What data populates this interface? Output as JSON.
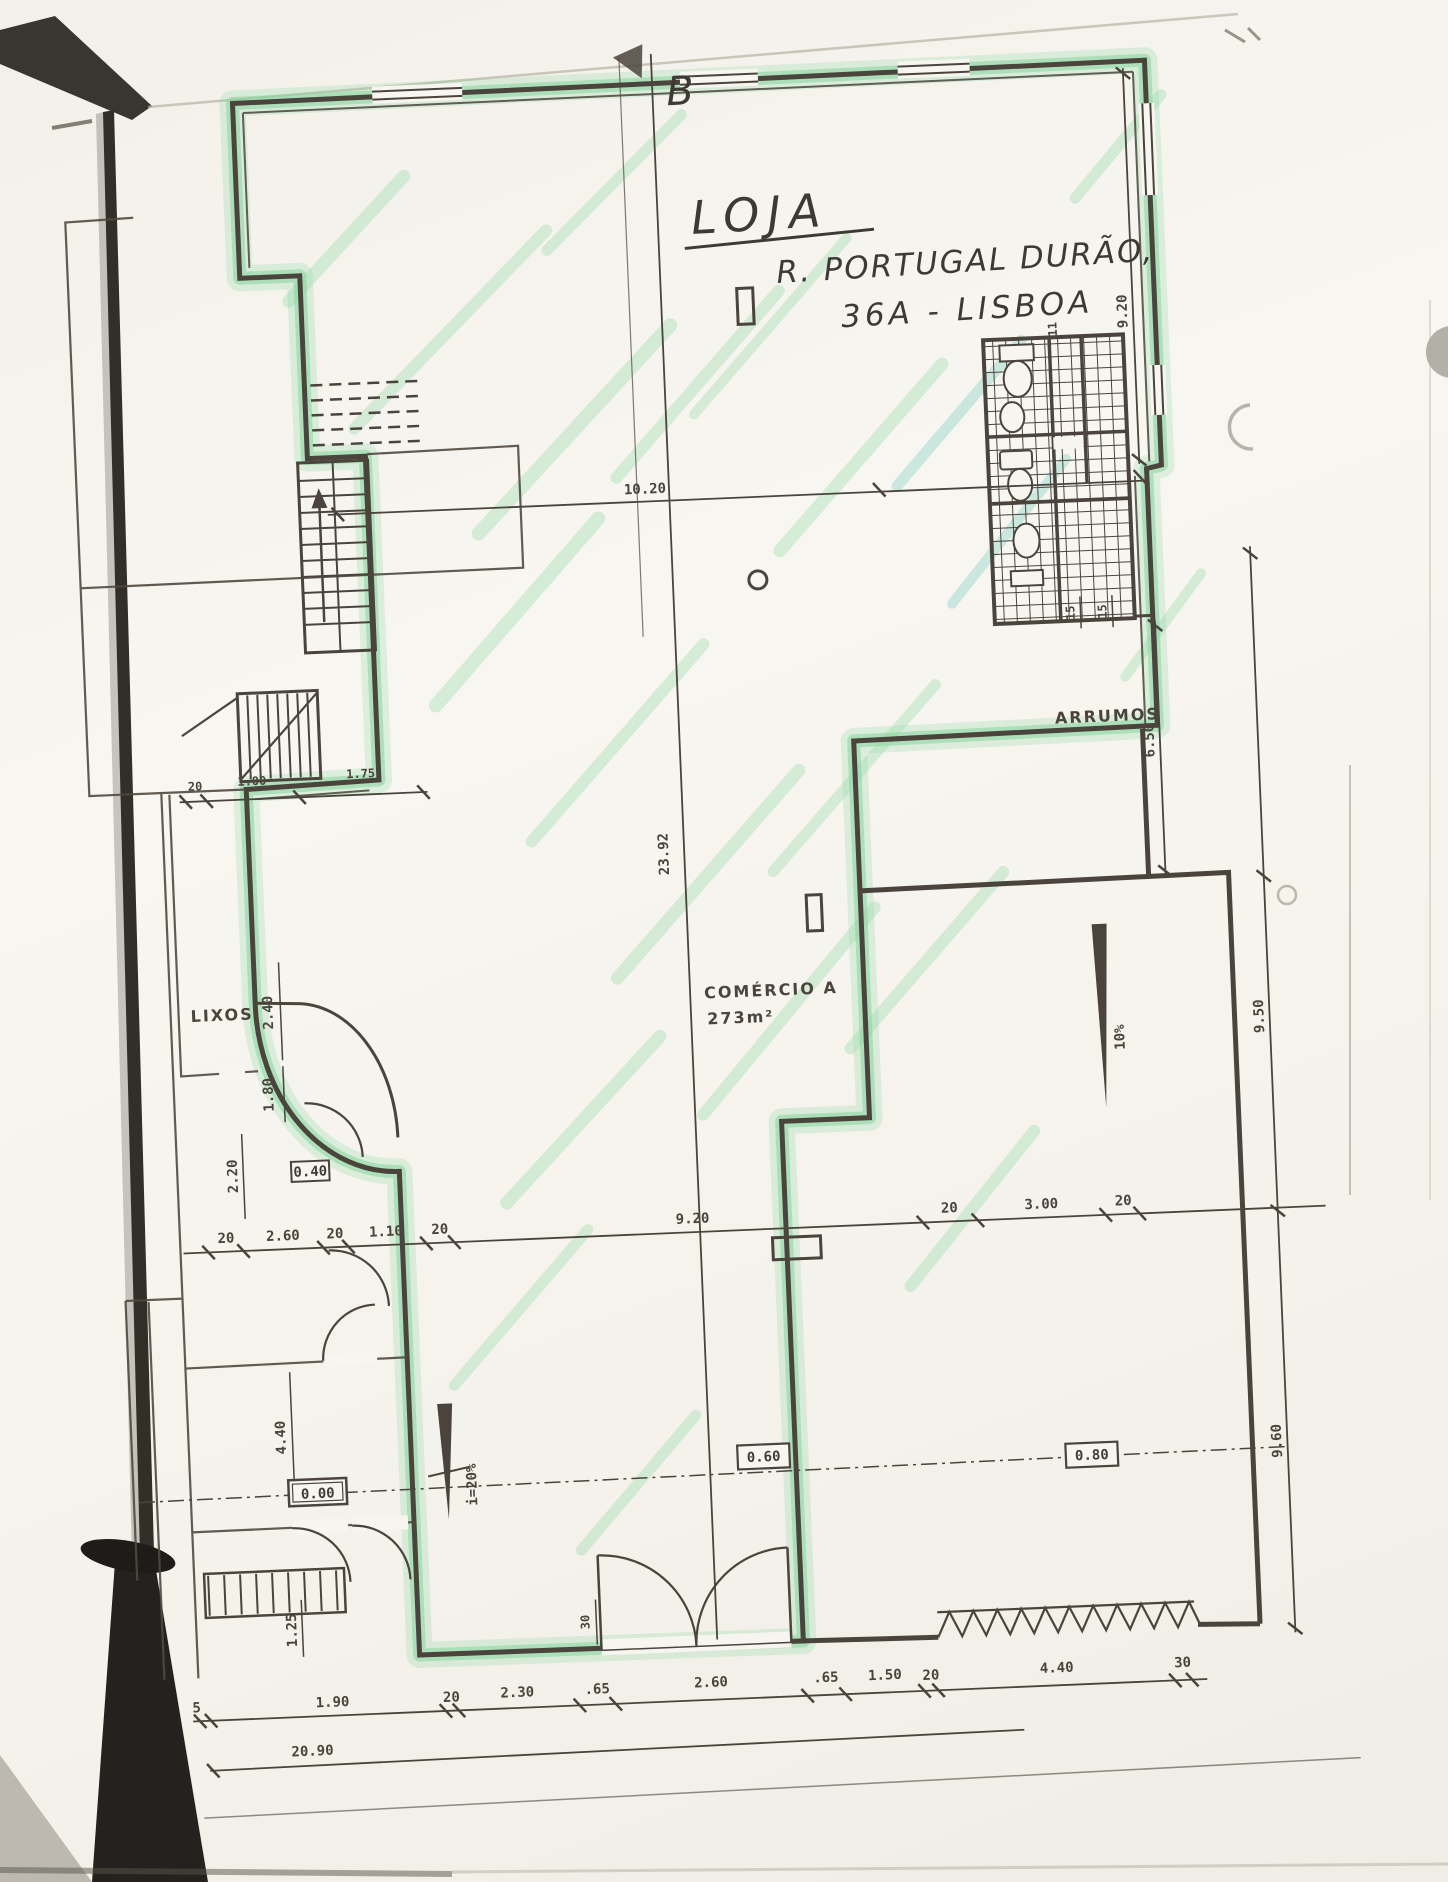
{
  "title": {
    "line1": "LOJA",
    "line2": "R. PORTUGAL DURÃO,",
    "line3": "36A - LISBOA"
  },
  "section_marker": "B",
  "rooms": {
    "storage": "ARRUMOS",
    "trash": "LIXOS",
    "commerce_name": "COMÉRCIO A",
    "commerce_area": "273m²"
  },
  "levels": {
    "entrance": "0.00",
    "mid": "0.60",
    "right": "0.80",
    "small": "0.40"
  },
  "ramps": {
    "left": "i=20%",
    "right": "10%"
  },
  "dims": {
    "top_width": "10.20",
    "stair": [
      "20",
      "1.00",
      "1.75"
    ],
    "middle": [
      "20",
      "2.60",
      "20",
      "1.10",
      "20",
      "9.20",
      "20",
      "3.00",
      "20"
    ],
    "bottom": [
      "5",
      "1.90",
      "20",
      "2.30",
      ".65",
      "2.60",
      ".65",
      "1.50",
      "20",
      "4.40",
      "30"
    ],
    "total": "20.90",
    "right_top": "9.20",
    "wc": [
      "15",
      "15"
    ],
    "wc_top": "11",
    "storage_height": "6.50",
    "right_mid": "9.50",
    "right_low": "9.60",
    "left": [
      "2.40",
      "1.80",
      "2.20",
      "4.40",
      "1.25"
    ],
    "door": "30",
    "depth": "23.92"
  },
  "colors": {
    "highlighter": "#86d69e",
    "ink": "#4a443d",
    "paper": "#f7f5ef"
  }
}
